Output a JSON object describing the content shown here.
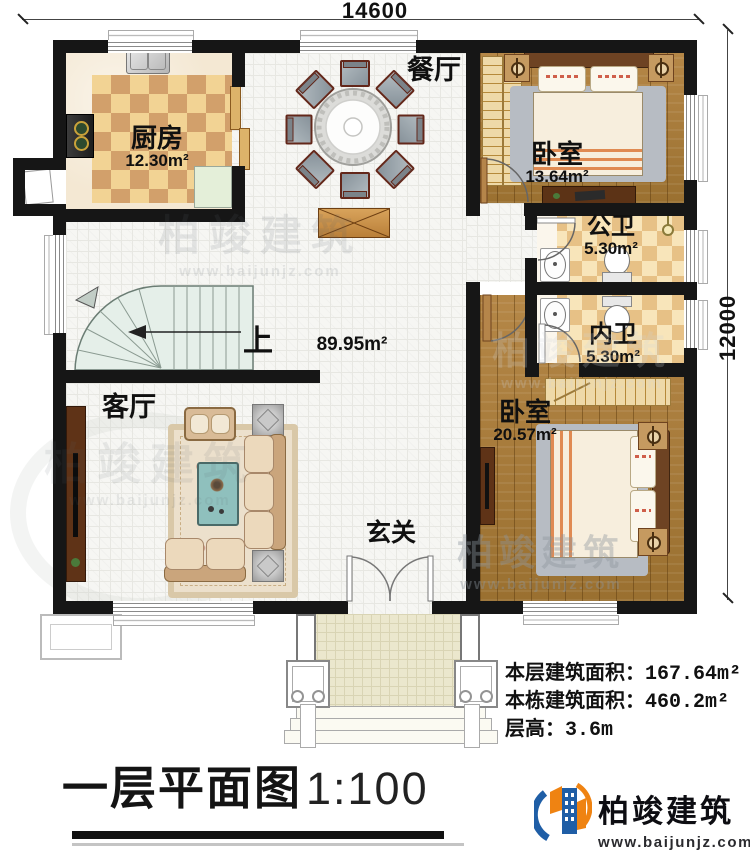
{
  "dimensions": {
    "width_label": "14600",
    "height_label": "12000"
  },
  "rooms": {
    "kitchen": {
      "label": "厨房",
      "area": "12.30m²"
    },
    "dining": {
      "label": "餐厅"
    },
    "bedroom1": {
      "label": "卧室",
      "area": "13.64m²"
    },
    "public_bath": {
      "label": "公卫",
      "area": "5.30m²"
    },
    "private_bath": {
      "label": "内卫",
      "area": "5.30m²"
    },
    "bedroom2": {
      "label": "卧室",
      "area": "20.57m²"
    },
    "living": {
      "label": "客厅"
    },
    "foyer": {
      "label": "玄关"
    },
    "stairs": {
      "label": "上"
    },
    "hall_area": "89.95m²"
  },
  "info": {
    "lines": [
      {
        "label": "本层建筑面积：",
        "value": "167.64m²"
      },
      {
        "label": "本栋建筑面积：",
        "value": "460.2m²"
      },
      {
        "label": "层高：",
        "value": "3.6m"
      }
    ]
  },
  "title": {
    "name": "一层平面图",
    "scale": "1:100"
  },
  "brand": {
    "name": "柏竣建筑",
    "site": "www.baijunjz.com"
  },
  "watermark": {
    "text": "柏竣建筑",
    "site": "www.baijunjz.com"
  },
  "colors": {
    "wall": "#161616",
    "brand_blue": "#1f5ea6",
    "brand_orange": "#ef8312"
  }
}
